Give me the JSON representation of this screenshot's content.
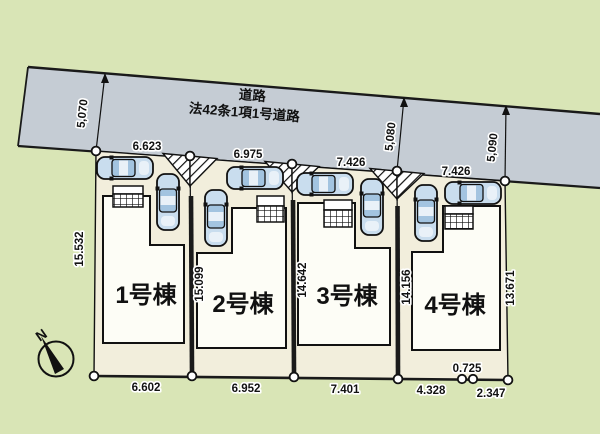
{
  "plan": {
    "road": {
      "name_line1": "道路",
      "name_line2": "法42条1項1号道路"
    },
    "road_widths": [
      "5,070",
      "5,080",
      "5,090"
    ],
    "frontages": [
      "6.623",
      "6.975",
      "7.426",
      "7.426"
    ],
    "side_depths": [
      "15.532",
      "15.099",
      "14.642",
      "14.156",
      "13.671"
    ],
    "bottom_widths": [
      "6.602",
      "6.952",
      "7.401",
      "4.328",
      "2.347"
    ],
    "bottom_jog": "0.725",
    "buildings": [
      "1号棟",
      "2号棟",
      "3号棟",
      "4号棟"
    ],
    "compass_north": "N"
  },
  "colors": {
    "bg": "#d9e5b6",
    "road": "#c5ccd4",
    "lot": "#f2eedc",
    "building": "#fdfdf6",
    "car-body": "#c9ddee",
    "car-window": "#a3c4e0",
    "line": "#1a1a1a"
  }
}
